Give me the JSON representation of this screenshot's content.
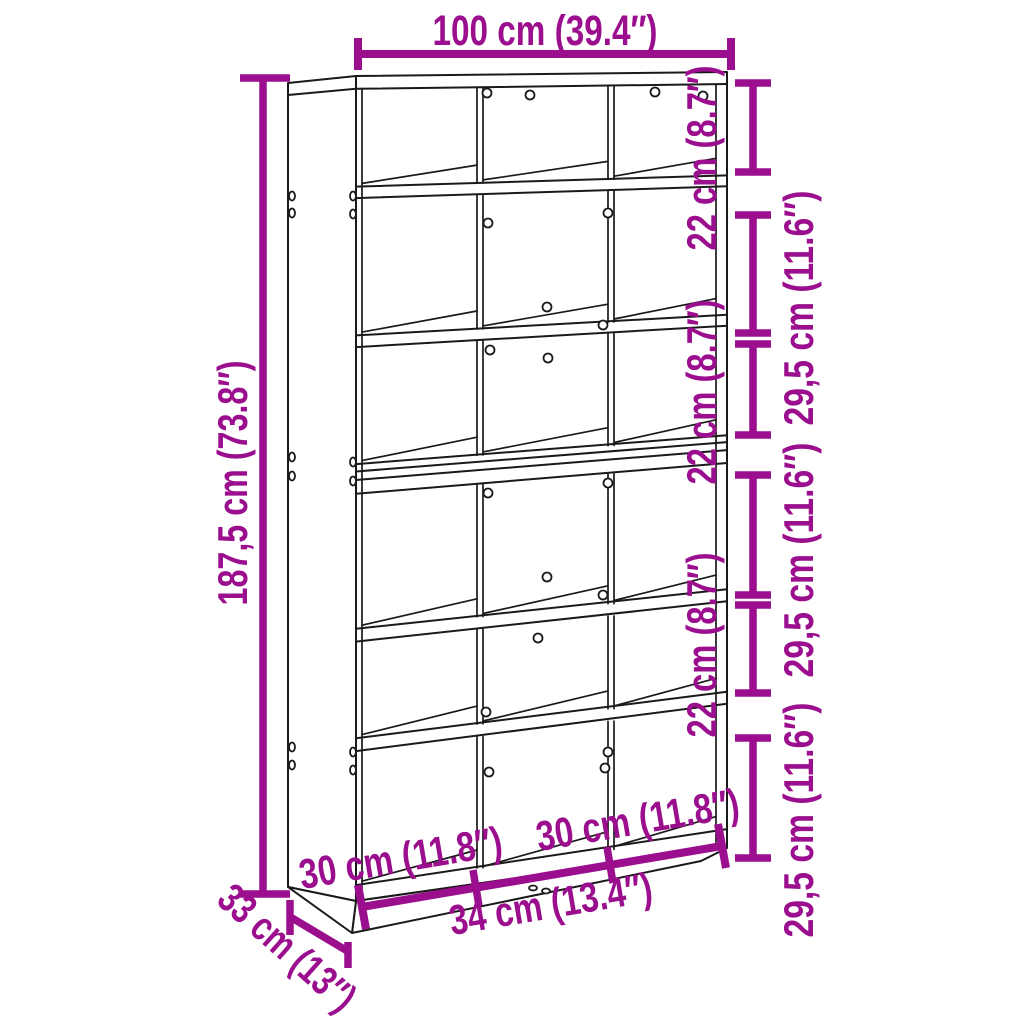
{
  "diagram": {
    "type": "furniture-dimension-drawing",
    "subject": "tall bookcase / room divider with 6 shelf tiers and 3 columns",
    "colors": {
      "dimension_accent": "#9B0E8E",
      "line_art": "#1a1a1a",
      "background": "#ffffff"
    },
    "dimensions": {
      "overall_width": {
        "text": "100 cm (39.4″)"
      },
      "overall_height": {
        "text": "187,5 cm (73.8″)"
      },
      "depth": {
        "text": "33 cm (13″)"
      },
      "shelf_heights_top_to_bottom": [
        {
          "text": "22 cm (8.7″)"
        },
        {
          "text": "29,5 cm (11.6″)"
        },
        {
          "text": "22 cm (8.7″)"
        },
        {
          "text": "29,5 cm (11.6″)"
        },
        {
          "text": "22 cm (8.7″)"
        },
        {
          "text": "29,5 cm (11.6″)"
        }
      ],
      "compartment_widths_left_to_right": [
        {
          "text": "30 cm (11.8″)"
        },
        {
          "text": "34 cm (13.4″)"
        },
        {
          "text": "30 cm (11.8″)"
        }
      ]
    }
  }
}
